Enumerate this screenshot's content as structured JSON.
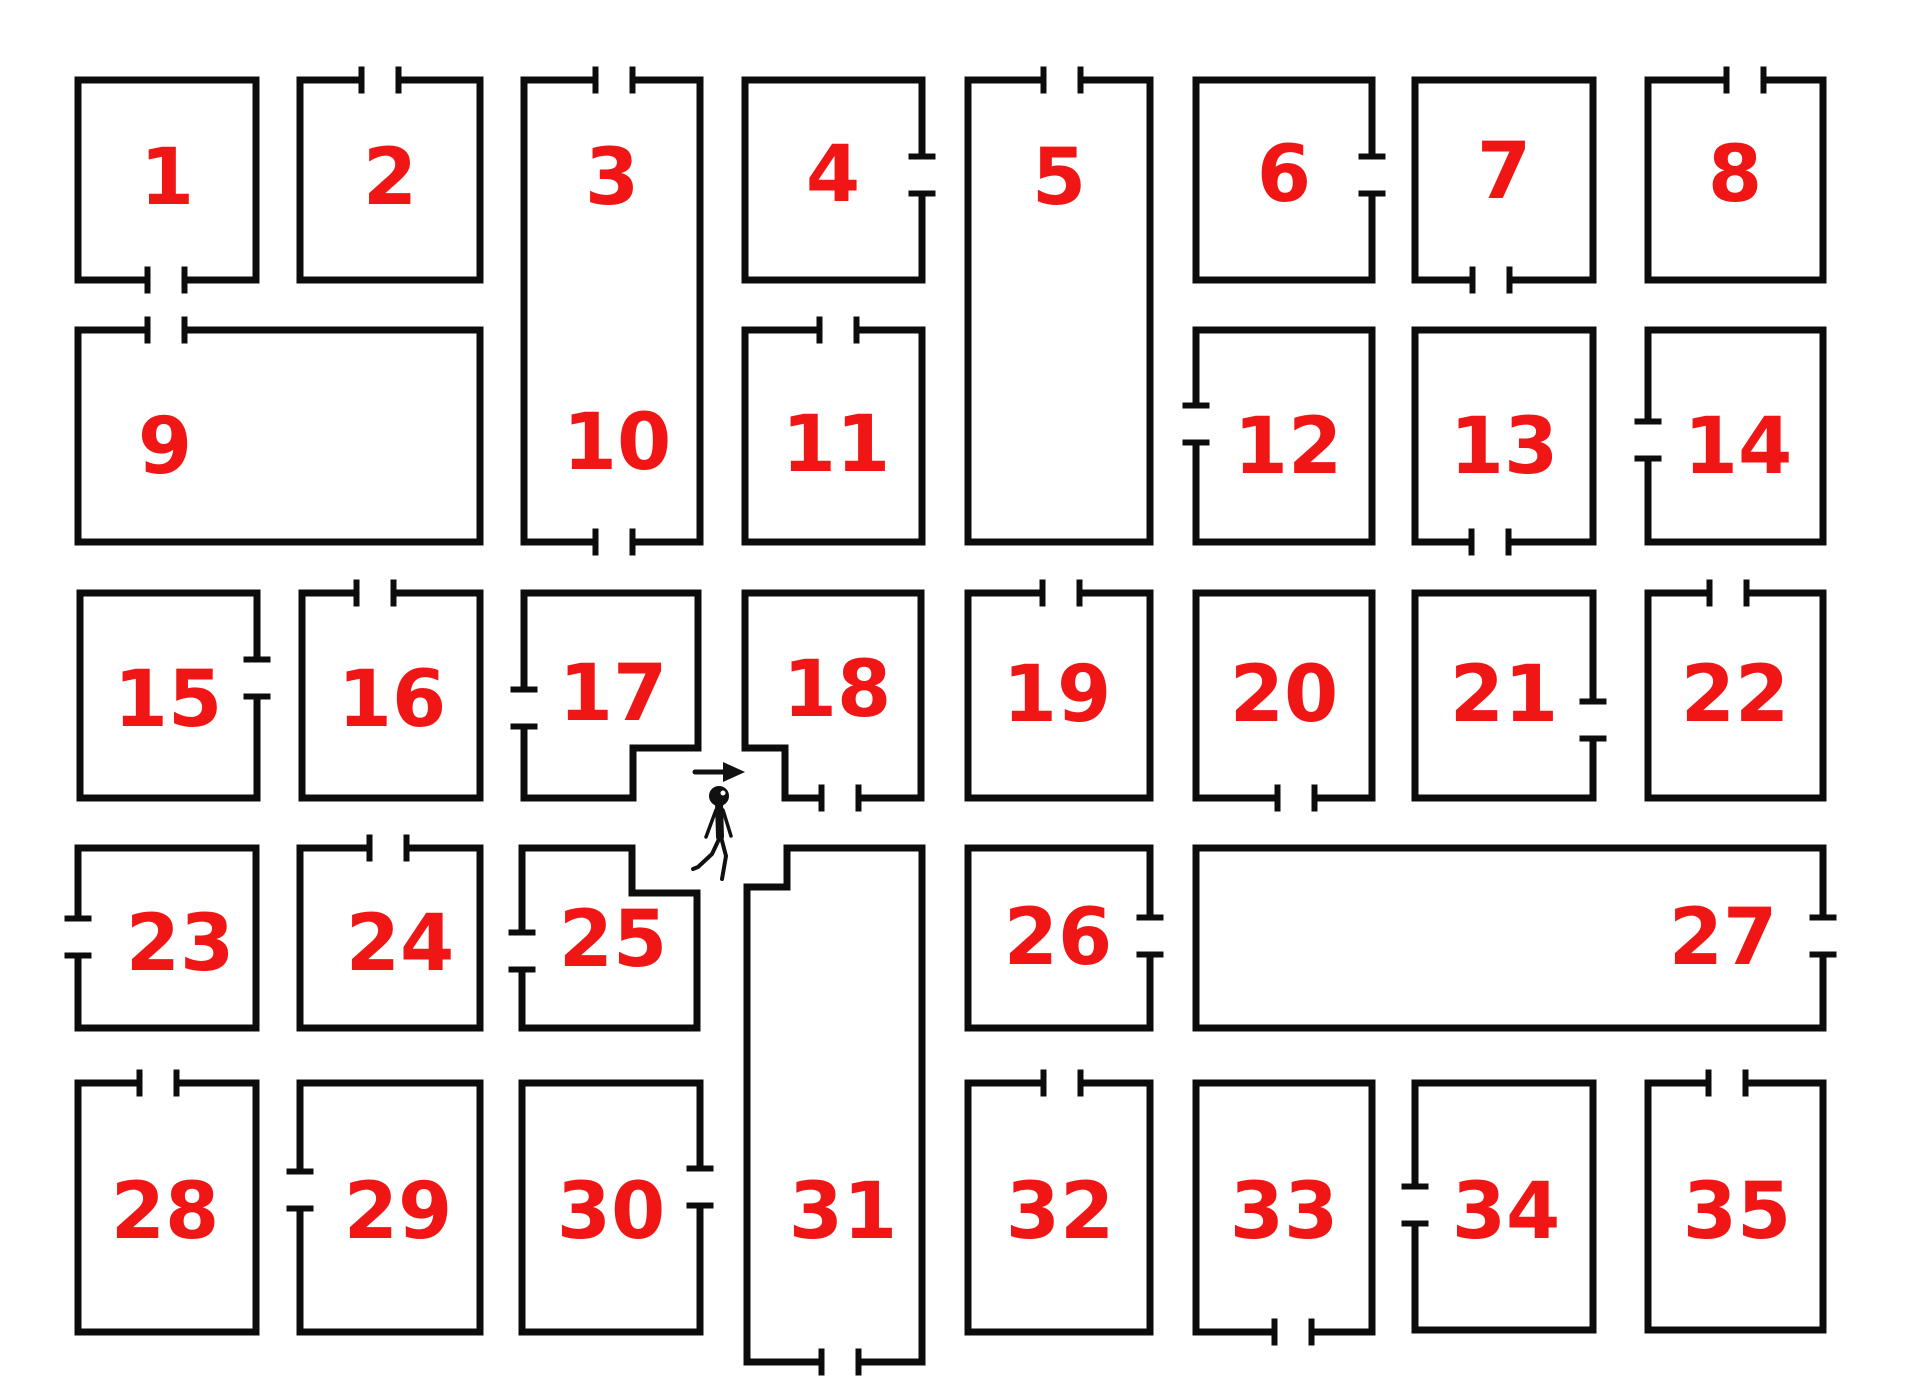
{
  "canvas": {
    "width": 1905,
    "height": 1400,
    "background": "#ffffff",
    "wall_color": "#0c0c0c",
    "wall_thickness": 7,
    "door_gap": 37,
    "tick_length": 27,
    "tick_thickness": 6,
    "number_color": "#f11616",
    "number_font_size": 78
  },
  "rooms": [
    {
      "id": "1",
      "labels": [
        {
          "text": "1",
          "x": 167,
          "y": 178
        }
      ],
      "outline": [
        [
          78,
          80
        ],
        [
          256,
          80
        ],
        [
          256,
          280
        ],
        [
          78,
          280
        ]
      ],
      "doors": [
        {
          "edge": 2,
          "center": 166
        }
      ]
    },
    {
      "id": "2",
      "labels": [
        {
          "text": "2",
          "x": 390,
          "y": 178
        }
      ],
      "outline": [
        [
          300,
          80
        ],
        [
          480,
          80
        ],
        [
          480,
          280
        ],
        [
          300,
          280
        ]
      ],
      "doors": [
        {
          "edge": 0,
          "center": 380
        }
      ]
    },
    {
      "id": "3-10",
      "labels": [
        {
          "text": "3",
          "x": 612,
          "y": 178
        },
        {
          "text": "10",
          "x": 617,
          "y": 443
        }
      ],
      "outline": [
        [
          524,
          80
        ],
        [
          700,
          80
        ],
        [
          700,
          542
        ],
        [
          524,
          542
        ]
      ],
      "doors": [
        {
          "edge": 0,
          "center": 614
        },
        {
          "edge": 2,
          "center": 614
        }
      ]
    },
    {
      "id": "4",
      "labels": [
        {
          "text": "4",
          "x": 833,
          "y": 175
        }
      ],
      "outline": [
        [
          745,
          80
        ],
        [
          922,
          80
        ],
        [
          922,
          280
        ],
        [
          745,
          280
        ]
      ],
      "doors": [
        {
          "edge": 1,
          "center": 175
        }
      ]
    },
    {
      "id": "5",
      "labels": [
        {
          "text": "5",
          "x": 1059,
          "y": 178
        }
      ],
      "outline": [
        [
          968,
          80
        ],
        [
          1150,
          80
        ],
        [
          1150,
          542
        ],
        [
          968,
          542
        ]
      ],
      "doors": [
        {
          "edge": 0,
          "center": 1062
        }
      ]
    },
    {
      "id": "6",
      "labels": [
        {
          "text": "6",
          "x": 1284,
          "y": 175
        }
      ],
      "outline": [
        [
          1196,
          80
        ],
        [
          1372,
          80
        ],
        [
          1372,
          280
        ],
        [
          1196,
          280
        ]
      ],
      "doors": [
        {
          "edge": 1,
          "center": 175
        }
      ]
    },
    {
      "id": "7",
      "labels": [
        {
          "text": "7",
          "x": 1504,
          "y": 172
        }
      ],
      "outline": [
        [
          1415,
          80
        ],
        [
          1593,
          80
        ],
        [
          1593,
          280
        ],
        [
          1415,
          280
        ]
      ],
      "doors": [
        {
          "edge": 2,
          "center": 1491
        }
      ]
    },
    {
      "id": "8",
      "labels": [
        {
          "text": "8",
          "x": 1735,
          "y": 175
        }
      ],
      "outline": [
        [
          1648,
          80
        ],
        [
          1823,
          80
        ],
        [
          1823,
          280
        ],
        [
          1648,
          280
        ]
      ],
      "doors": [
        {
          "edge": 0,
          "center": 1745
        }
      ]
    },
    {
      "id": "9",
      "labels": [
        {
          "text": "9",
          "x": 165,
          "y": 447
        }
      ],
      "outline": [
        [
          78,
          330
        ],
        [
          480,
          330
        ],
        [
          480,
          542
        ],
        [
          78,
          542
        ]
      ],
      "doors": [
        {
          "edge": 0,
          "center": 166
        }
      ]
    },
    {
      "id": "11",
      "labels": [
        {
          "text": "11",
          "x": 836,
          "y": 445
        }
      ],
      "outline": [
        [
          745,
          330
        ],
        [
          922,
          330
        ],
        [
          922,
          542
        ],
        [
          745,
          542
        ]
      ],
      "doors": [
        {
          "edge": 0,
          "center": 838
        }
      ]
    },
    {
      "id": "12",
      "labels": [
        {
          "text": "12",
          "x": 1288,
          "y": 447
        }
      ],
      "outline": [
        [
          1196,
          330
        ],
        [
          1372,
          330
        ],
        [
          1372,
          542
        ],
        [
          1196,
          542
        ]
      ],
      "doors": [
        {
          "edge": 3,
          "center": 424
        }
      ]
    },
    {
      "id": "13",
      "labels": [
        {
          "text": "13",
          "x": 1504,
          "y": 447
        }
      ],
      "outline": [
        [
          1415,
          330
        ],
        [
          1593,
          330
        ],
        [
          1593,
          542
        ],
        [
          1415,
          542
        ]
      ],
      "doors": [
        {
          "edge": 2,
          "center": 1490
        }
      ]
    },
    {
      "id": "14",
      "labels": [
        {
          "text": "14",
          "x": 1738,
          "y": 447
        }
      ],
      "outline": [
        [
          1648,
          330
        ],
        [
          1823,
          330
        ],
        [
          1823,
          542
        ],
        [
          1648,
          542
        ]
      ],
      "doors": [
        {
          "edge": 3,
          "center": 440
        }
      ]
    },
    {
      "id": "15",
      "labels": [
        {
          "text": "15",
          "x": 168,
          "y": 700
        }
      ],
      "outline": [
        [
          80,
          593
        ],
        [
          257,
          593
        ],
        [
          257,
          798
        ],
        [
          80,
          798
        ]
      ],
      "doors": [
        {
          "edge": 1,
          "center": 678
        }
      ]
    },
    {
      "id": "16",
      "labels": [
        {
          "text": "16",
          "x": 392,
          "y": 700
        }
      ],
      "outline": [
        [
          302,
          593
        ],
        [
          480,
          593
        ],
        [
          480,
          798
        ],
        [
          302,
          798
        ]
      ],
      "doors": [
        {
          "edge": 0,
          "center": 375
        }
      ]
    },
    {
      "id": "17",
      "labels": [
        {
          "text": "17",
          "x": 613,
          "y": 694
        }
      ],
      "outline": [
        [
          524,
          593
        ],
        [
          698,
          593
        ],
        [
          698,
          748
        ],
        [
          633,
          748
        ],
        [
          633,
          798
        ],
        [
          524,
          798
        ]
      ],
      "doors": [
        {
          "edge": 5,
          "center": 708
        }
      ]
    },
    {
      "id": "18",
      "labels": [
        {
          "text": "18",
          "x": 837,
          "y": 690
        }
      ],
      "outline": [
        [
          745,
          593
        ],
        [
          921,
          593
        ],
        [
          921,
          798
        ],
        [
          785,
          798
        ],
        [
          785,
          748
        ],
        [
          745,
          748
        ]
      ],
      "doors": [
        {
          "edge": 2,
          "center": 840
        }
      ]
    },
    {
      "id": "19",
      "labels": [
        {
          "text": "19",
          "x": 1057,
          "y": 695
        }
      ],
      "outline": [
        [
          968,
          593
        ],
        [
          1150,
          593
        ],
        [
          1150,
          798
        ],
        [
          968,
          798
        ]
      ],
      "doors": [
        {
          "edge": 0,
          "center": 1061
        }
      ]
    },
    {
      "id": "20",
      "labels": [
        {
          "text": "20",
          "x": 1284,
          "y": 695
        }
      ],
      "outline": [
        [
          1196,
          593
        ],
        [
          1372,
          593
        ],
        [
          1372,
          798
        ],
        [
          1196,
          798
        ]
      ],
      "doors": [
        {
          "edge": 2,
          "center": 1296
        }
      ]
    },
    {
      "id": "21",
      "labels": [
        {
          "text": "21",
          "x": 1504,
          "y": 695
        }
      ],
      "outline": [
        [
          1415,
          593
        ],
        [
          1593,
          593
        ],
        [
          1593,
          798
        ],
        [
          1415,
          798
        ]
      ],
      "doors": [
        {
          "edge": 1,
          "center": 720
        }
      ]
    },
    {
      "id": "22",
      "labels": [
        {
          "text": "22",
          "x": 1735,
          "y": 695
        }
      ],
      "outline": [
        [
          1648,
          593
        ],
        [
          1823,
          593
        ],
        [
          1823,
          798
        ],
        [
          1648,
          798
        ]
      ],
      "doors": [
        {
          "edge": 0,
          "center": 1728
        }
      ]
    },
    {
      "id": "23",
      "labels": [
        {
          "text": "23",
          "x": 180,
          "y": 944
        }
      ],
      "outline": [
        [
          78,
          848
        ],
        [
          256,
          848
        ],
        [
          256,
          1028
        ],
        [
          78,
          1028
        ]
      ],
      "doors": [
        {
          "edge": 3,
          "center": 937
        }
      ]
    },
    {
      "id": "24",
      "labels": [
        {
          "text": "24",
          "x": 400,
          "y": 944
        }
      ],
      "outline": [
        [
          300,
          848
        ],
        [
          480,
          848
        ],
        [
          480,
          1028
        ],
        [
          300,
          1028
        ]
      ],
      "doors": [
        {
          "edge": 0,
          "center": 388
        }
      ]
    },
    {
      "id": "25",
      "labels": [
        {
          "text": "25",
          "x": 613,
          "y": 940
        }
      ],
      "outline": [
        [
          522,
          848
        ],
        [
          632,
          848
        ],
        [
          632,
          893
        ],
        [
          697,
          893
        ],
        [
          697,
          1028
        ],
        [
          522,
          1028
        ]
      ],
      "doors": [
        {
          "edge": 5,
          "center": 951
        }
      ]
    },
    {
      "id": "26",
      "labels": [
        {
          "text": "26",
          "x": 1058,
          "y": 938
        }
      ],
      "outline": [
        [
          968,
          848
        ],
        [
          1150,
          848
        ],
        [
          1150,
          1028
        ],
        [
          968,
          1028
        ]
      ],
      "doors": [
        {
          "edge": 1,
          "center": 936
        }
      ]
    },
    {
      "id": "27",
      "labels": [
        {
          "text": "27",
          "x": 1723,
          "y": 938
        }
      ],
      "outline": [
        [
          1196,
          848
        ],
        [
          1823,
          848
        ],
        [
          1823,
          1028
        ],
        [
          1196,
          1028
        ]
      ],
      "doors": [
        {
          "edge": 1,
          "center": 936
        }
      ]
    },
    {
      "id": "28",
      "labels": [
        {
          "text": "28",
          "x": 165,
          "y": 1212
        }
      ],
      "outline": [
        [
          78,
          1083
        ],
        [
          256,
          1083
        ],
        [
          256,
          1332
        ],
        [
          78,
          1332
        ]
      ],
      "doors": [
        {
          "edge": 0,
          "center": 158
        }
      ]
    },
    {
      "id": "29",
      "labels": [
        {
          "text": "29",
          "x": 398,
          "y": 1212
        }
      ],
      "outline": [
        [
          300,
          1083
        ],
        [
          480,
          1083
        ],
        [
          480,
          1332
        ],
        [
          300,
          1332
        ]
      ],
      "doors": [
        {
          "edge": 3,
          "center": 1190
        }
      ]
    },
    {
      "id": "30",
      "labels": [
        {
          "text": "30",
          "x": 611,
          "y": 1212
        }
      ],
      "outline": [
        [
          522,
          1083
        ],
        [
          700,
          1083
        ],
        [
          700,
          1332
        ],
        [
          522,
          1332
        ]
      ],
      "doors": [
        {
          "edge": 1,
          "center": 1187
        }
      ]
    },
    {
      "id": "31",
      "labels": [
        {
          "text": "31",
          "x": 843,
          "y": 1212
        }
      ],
      "outline": [
        [
          787,
          848
        ],
        [
          922,
          848
        ],
        [
          922,
          1362
        ],
        [
          747,
          1362
        ],
        [
          747,
          887
        ],
        [
          787,
          887
        ]
      ],
      "doors": [
        {
          "edge": 2,
          "center": 840
        }
      ]
    },
    {
      "id": "32",
      "labels": [
        {
          "text": "32",
          "x": 1060,
          "y": 1212
        }
      ],
      "outline": [
        [
          968,
          1083
        ],
        [
          1150,
          1083
        ],
        [
          1150,
          1332
        ],
        [
          968,
          1332
        ]
      ],
      "doors": [
        {
          "edge": 0,
          "center": 1062
        }
      ]
    },
    {
      "id": "33",
      "labels": [
        {
          "text": "33",
          "x": 1284,
          "y": 1212
        }
      ],
      "outline": [
        [
          1196,
          1083
        ],
        [
          1372,
          1083
        ],
        [
          1372,
          1332
        ],
        [
          1196,
          1332
        ]
      ],
      "doors": [
        {
          "edge": 2,
          "center": 1293
        }
      ]
    },
    {
      "id": "34",
      "labels": [
        {
          "text": "34",
          "x": 1506,
          "y": 1212
        }
      ],
      "outline": [
        [
          1415,
          1083
        ],
        [
          1593,
          1083
        ],
        [
          1593,
          1330
        ],
        [
          1415,
          1330
        ]
      ],
      "doors": [
        {
          "edge": 3,
          "center": 1205
        }
      ]
    },
    {
      "id": "35",
      "labels": [
        {
          "text": "35",
          "x": 1737,
          "y": 1212
        }
      ],
      "outline": [
        [
          1648,
          1083
        ],
        [
          1823,
          1083
        ],
        [
          1823,
          1330
        ],
        [
          1648,
          1330
        ]
      ],
      "doors": [
        {
          "edge": 0,
          "center": 1727
        }
      ]
    }
  ],
  "figure": {
    "color": "#111111",
    "arrow": {
      "line": [
        695,
        772,
        726,
        772
      ],
      "head": [
        [
          745,
          772
        ],
        [
          723,
          762
        ],
        [
          723,
          782
        ]
      ]
    },
    "head": {
      "cx": 719,
      "cy": 796,
      "r": 9
    },
    "face_dot": {
      "cx": 723,
      "cy": 793,
      "r": 2.5
    },
    "torso": [
      719,
      803,
      720,
      837
    ],
    "arms": [
      [
        716,
        810,
        706,
        837
      ],
      [
        723,
        810,
        731,
        836
      ]
    ],
    "legs": [
      [
        [
          720,
          837
        ],
        [
          712,
          854
        ],
        [
          698,
          867
        ],
        [
          693,
          869
        ]
      ],
      [
        [
          721,
          837
        ],
        [
          726,
          856
        ],
        [
          722,
          879
        ]
      ]
    ]
  }
}
